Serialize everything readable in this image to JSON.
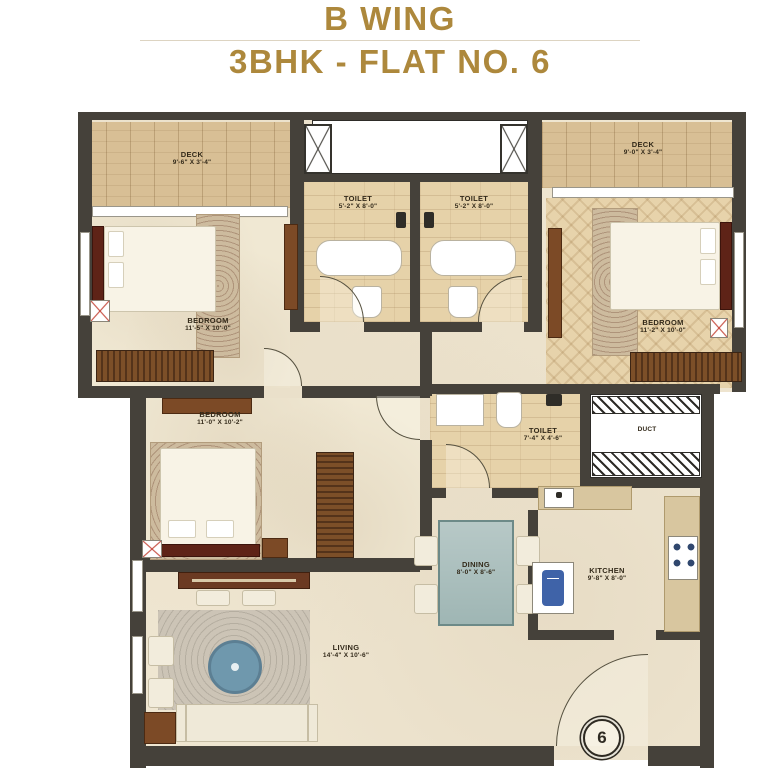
{
  "title": {
    "line1": "B WING",
    "line2": "3BHK - FLAT NO. 6"
  },
  "colors": {
    "accent_gold": "#AD883C",
    "wall": "#45413A",
    "deck_wood": "#D8BF95",
    "toilet_wood": "#E6D2A9",
    "floor_beige": "#EFE6D1",
    "furniture_dark_red": "#5E2317",
    "wardrobe_brown": "#7C4F28",
    "coffee_table_blue": "#6F98AD",
    "dining_table_teal": "#9FB6B4",
    "appliance_blue": "#3F63A8",
    "ac_mark_red": "#C0392B"
  },
  "rooms": {
    "deck_left": {
      "label": "DECK",
      "dims": "9'-6\" X 3'-4\""
    },
    "deck_right": {
      "label": "DECK",
      "dims": "9'-0\" X 3'-4\""
    },
    "toilet_left": {
      "label": "TOILET",
      "dims": "5'-2\" X 8'-0\""
    },
    "toilet_right": {
      "label": "TOILET",
      "dims": "5'-2\" X 8'-0\""
    },
    "bedroom_left": {
      "label": "BEDROOM",
      "dims": "11'-5\" X 10'-0\""
    },
    "bedroom_right": {
      "label": "BEDROOM",
      "dims": "11'-2\" X 10'-0\""
    },
    "bedroom_mid": {
      "label": "BEDROOM",
      "dims": "11'-0\" X 10'-2\""
    },
    "toilet_common": {
      "label": "TOILET",
      "dims": "7'-4\" X 4'-6\""
    },
    "dining": {
      "label": "DINING",
      "dims": "8'-0\" X 8'-6\""
    },
    "kitchen": {
      "label": "KITCHEN",
      "dims": "9'-8\" X 8'-0\""
    },
    "living": {
      "label": "LIVING",
      "dims": "14'-4\" X 10'-6\""
    },
    "duct": {
      "label": "DUCT"
    }
  },
  "entrance": {
    "flat_number": "6"
  }
}
